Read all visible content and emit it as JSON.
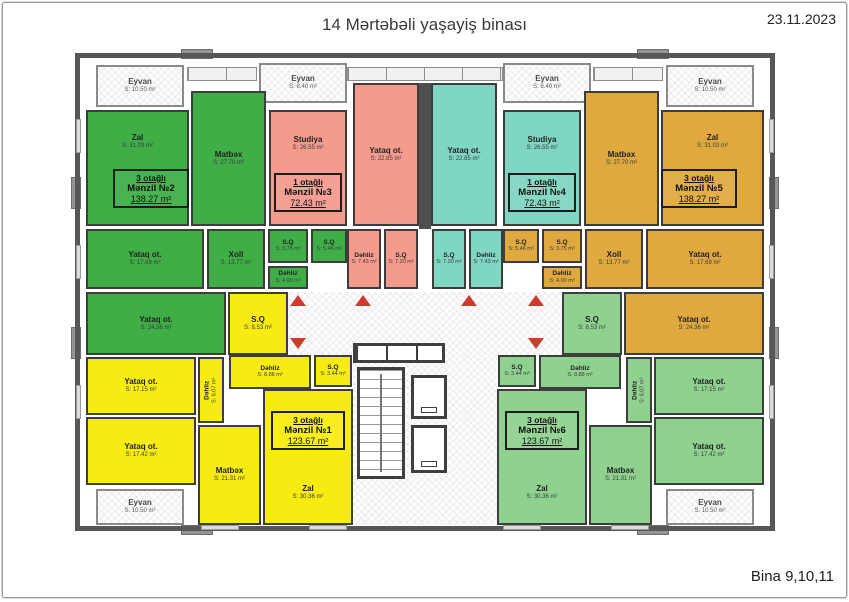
{
  "header": {
    "title": "14 Mərtəbəli yaşayiş binası",
    "date": "23.11.2023"
  },
  "footer": {
    "building": "Bina 9,10,11"
  },
  "colors": {
    "apt1": "#f7ec11",
    "apt2": "#3fae47",
    "apt3": "#f59b8e",
    "apt4": "#7fd6c2",
    "apt5": "#e0a93f",
    "apt6": "#8fd28f",
    "arrow": "#cd3a2e",
    "wall": "#4f4f4f"
  },
  "plan": {
    "rooms": [
      {
        "id": "eyvan-2",
        "apt": 2,
        "balcony": true,
        "name": "Eyvan",
        "area": "S: 10.50 m²",
        "x": 15,
        "y": 6,
        "w": 88,
        "h": 42
      },
      {
        "id": "eyvan-3",
        "apt": 3,
        "balcony": true,
        "name": "Eyvan",
        "area": "S: 8.40 m²",
        "x": 178,
        "y": 4,
        "w": 88,
        "h": 40
      },
      {
        "id": "eyvan-4",
        "apt": 4,
        "balcony": true,
        "name": "Eyvan",
        "area": "S: 8.40 m²",
        "x": 422,
        "y": 4,
        "w": 88,
        "h": 40
      },
      {
        "id": "eyvan-5",
        "apt": 5,
        "balcony": true,
        "name": "Eyvan",
        "area": "S: 10.50 m²",
        "x": 585,
        "y": 6,
        "w": 88,
        "h": 42
      },
      {
        "id": "zal-2",
        "apt": 2,
        "name": "Zal",
        "area": "S: 31.03 m²",
        "x": 5,
        "y": 51,
        "w": 103,
        "h": 116,
        "ty": -26
      },
      {
        "id": "matbex-2",
        "apt": 2,
        "name": "Matbəx",
        "area": "S: 27.70 m²",
        "x": 110,
        "y": 32,
        "w": 75,
        "h": 135
      },
      {
        "id": "yataq-2a",
        "apt": 2,
        "name": "Yataq ot.",
        "area": "S: 17.69 m²",
        "x": 5,
        "y": 170,
        "w": 118,
        "h": 60
      },
      {
        "id": "xoll-2",
        "apt": 2,
        "name": "Xoll",
        "area": "S: 13.77 m²",
        "x": 126,
        "y": 170,
        "w": 58,
        "h": 60
      },
      {
        "id": "sq-2a",
        "apt": 2,
        "small": true,
        "name": "S.Q",
        "area": "S: 3.75 m²",
        "x": 187,
        "y": 170,
        "w": 40,
        "h": 34
      },
      {
        "id": "sq-2b",
        "apt": 2,
        "small": true,
        "name": "S.Q",
        "area": "S: 5.46 m²",
        "x": 230,
        "y": 170,
        "w": 36,
        "h": 34
      },
      {
        "id": "dehliz-2",
        "apt": 2,
        "small": true,
        "name": "Dəhliz",
        "area": "S: 4.00 m²",
        "x": 187,
        "y": 207,
        "w": 40,
        "h": 23
      },
      {
        "id": "yataq-2b",
        "apt": 2,
        "name": "Yataq ot.",
        "area": "S: 24.36 m²",
        "x": 5,
        "y": 233,
        "w": 140,
        "h": 63
      },
      {
        "id": "studiya-3",
        "apt": 3,
        "name": "Studiya",
        "area": "S: 26.55 m²",
        "x": 188,
        "y": 51,
        "w": 78,
        "h": 116,
        "ty": -24
      },
      {
        "id": "yataq-3",
        "apt": 3,
        "name": "Yataq ot.",
        "area": "S: 22.85 m²",
        "x": 272,
        "y": 24,
        "w": 66,
        "h": 143
      },
      {
        "id": "dehliz-3",
        "apt": 3,
        "small": true,
        "name": "Dəhliz",
        "area": "S: 7.43 m²",
        "x": 266,
        "y": 170,
        "w": 34,
        "h": 60
      },
      {
        "id": "sq-3",
        "apt": 3,
        "small": true,
        "name": "S.Q",
        "area": "S: 7.20 m²",
        "x": 303,
        "y": 170,
        "w": 34,
        "h": 60
      },
      {
        "id": "yataq-4",
        "apt": 4,
        "name": "Yataq ot.",
        "area": "S: 22.85 m²",
        "x": 350,
        "y": 24,
        "w": 66,
        "h": 143
      },
      {
        "id": "studiya-4",
        "apt": 4,
        "name": "Studiya",
        "area": "S: 26.55 m²",
        "x": 422,
        "y": 51,
        "w": 78,
        "h": 116,
        "ty": -24
      },
      {
        "id": "sq-4",
        "apt": 4,
        "small": true,
        "name": "S.Q",
        "area": "S: 7.20 m²",
        "x": 351,
        "y": 170,
        "w": 34,
        "h": 60
      },
      {
        "id": "dehliz-4",
        "apt": 4,
        "small": true,
        "name": "Dəhliz",
        "area": "S: 7.43 m²",
        "x": 388,
        "y": 170,
        "w": 34,
        "h": 60
      },
      {
        "id": "matbex-5",
        "apt": 5,
        "name": "Matbəx",
        "area": "S: 27.70 m²",
        "x": 503,
        "y": 32,
        "w": 75,
        "h": 135
      },
      {
        "id": "zal-5",
        "apt": 5,
        "name": "Zal",
        "area": "S: 31.03 m²",
        "x": 580,
        "y": 51,
        "w": 103,
        "h": 116,
        "ty": -26
      },
      {
        "id": "sq-5b",
        "apt": 5,
        "small": true,
        "name": "S.Q",
        "area": "S: 5.46 m²",
        "x": 422,
        "y": 170,
        "w": 36,
        "h": 34
      },
      {
        "id": "sq-5a",
        "apt": 5,
        "small": true,
        "name": "S.Q",
        "area": "S: 3.75 m²",
        "x": 461,
        "y": 170,
        "w": 40,
        "h": 34
      },
      {
        "id": "dehliz-5",
        "apt": 5,
        "small": true,
        "name": "Dəhliz",
        "area": "S: 4.00 m²",
        "x": 461,
        "y": 207,
        "w": 40,
        "h": 23
      },
      {
        "id": "xoll-5",
        "apt": 5,
        "name": "Xoll",
        "area": "S: 13.77 m²",
        "x": 504,
        "y": 170,
        "w": 58,
        "h": 60
      },
      {
        "id": "yataq-5a",
        "apt": 5,
        "name": "Yataq ot.",
        "area": "S: 17.69 m²",
        "x": 565,
        "y": 170,
        "w": 118,
        "h": 60
      },
      {
        "id": "yataq-5b",
        "apt": 5,
        "name": "Yataq ot.",
        "area": "S: 24.36 m²",
        "x": 543,
        "y": 233,
        "w": 140,
        "h": 63
      },
      {
        "id": "sq-1a",
        "apt": 1,
        "name": "S.Q",
        "area": "S: 8.53 m²",
        "x": 147,
        "y": 233,
        "w": 60,
        "h": 63
      },
      {
        "id": "yataq-1a",
        "apt": 1,
        "name": "Yataq ot.",
        "area": "S: 17.15 m²",
        "x": 5,
        "y": 298,
        "w": 110,
        "h": 58
      },
      {
        "id": "dehliz-1b",
        "apt": 1,
        "small": true,
        "vertical": true,
        "name": "Dəhliz",
        "area": "S: 6.07 m²",
        "x": 117,
        "y": 298,
        "w": 26,
        "h": 66
      },
      {
        "id": "dehliz-1a",
        "apt": 1,
        "small": true,
        "name": "Dəhliz",
        "area": "S: 8.88 m²",
        "x": 148,
        "y": 296,
        "w": 82,
        "h": 34
      },
      {
        "id": "sq-1b",
        "apt": 1,
        "small": true,
        "name": "S.Q",
        "area": "S: 3.44 m²",
        "x": 233,
        "y": 296,
        "w": 38,
        "h": 32
      },
      {
        "id": "yataq-1b",
        "apt": 1,
        "name": "Yataq ot.",
        "area": "S: 17.42 m²",
        "x": 5,
        "y": 358,
        "w": 110,
        "h": 68
      },
      {
        "id": "matbex-1",
        "apt": 1,
        "name": "Matbəx",
        "area": "S: 21.31 m²",
        "x": 117,
        "y": 366,
        "w": 63,
        "h": 100
      },
      {
        "id": "zal-1",
        "apt": 1,
        "name": "Zal",
        "area": "S: 30.36 m²",
        "x": 182,
        "y": 330,
        "w": 90,
        "h": 136,
        "ty": 36
      },
      {
        "id": "eyvan-1",
        "apt": 1,
        "balcony": true,
        "name": "Eyvan",
        "area": "S: 10.50 m²",
        "x": 15,
        "y": 430,
        "w": 88,
        "h": 36
      },
      {
        "id": "sq-6a",
        "apt": 6,
        "name": "S.Q",
        "area": "S: 8.53 m²",
        "x": 481,
        "y": 233,
        "w": 60,
        "h": 63
      },
      {
        "id": "sq-6b",
        "apt": 6,
        "small": true,
        "name": "S.Q",
        "area": "S: 3.44 m²",
        "x": 417,
        "y": 296,
        "w": 38,
        "h": 32
      },
      {
        "id": "dehliz-6a",
        "apt": 6,
        "small": true,
        "name": "Dəhliz",
        "area": "S: 8.88 m²",
        "x": 458,
        "y": 296,
        "w": 82,
        "h": 34
      },
      {
        "id": "dehliz-6b",
        "apt": 6,
        "small": true,
        "vertical": true,
        "name": "Dəhliz",
        "area": "S: 6.07 m²",
        "x": 545,
        "y": 298,
        "w": 26,
        "h": 66
      },
      {
        "id": "yataq-6a",
        "apt": 6,
        "name": "Yataq ot.",
        "area": "S: 17.15 m²",
        "x": 573,
        "y": 298,
        "w": 110,
        "h": 58
      },
      {
        "id": "yataq-6b",
        "apt": 6,
        "name": "Yataq ot.",
        "area": "S: 17.42 m²",
        "x": 573,
        "y": 358,
        "w": 110,
        "h": 68
      },
      {
        "id": "zal-6",
        "apt": 6,
        "name": "Zal",
        "area": "S: 30.36 m²",
        "x": 416,
        "y": 330,
        "w": 90,
        "h": 136,
        "ty": 36
      },
      {
        "id": "matbex-6",
        "apt": 6,
        "name": "Matbəx",
        "area": "S: 21.31 m²",
        "x": 508,
        "y": 366,
        "w": 63,
        "h": 100
      },
      {
        "id": "eyvan-6",
        "apt": 6,
        "balcony": true,
        "name": "Eyvan",
        "area": "S: 10.50 m²",
        "x": 585,
        "y": 430,
        "w": 88,
        "h": 36
      }
    ],
    "unit_labels": [
      {
        "apt": 2,
        "lines": [
          "3 otağlı",
          "Mənzil №2",
          "138.27 m²"
        ],
        "x": 32,
        "y": 110,
        "w": 76
      },
      {
        "apt": 3,
        "lines": [
          "1 otağlı",
          "Mənzil №3",
          "72.43 m²"
        ],
        "x": 193,
        "y": 114,
        "w": 68
      },
      {
        "apt": 4,
        "lines": [
          "1 otağlı",
          "Mənzil №4",
          "72.43 m²"
        ],
        "x": 427,
        "y": 114,
        "w": 68
      },
      {
        "apt": 5,
        "lines": [
          "3 otağlı",
          "Mənzil №5",
          "138.27 m²"
        ],
        "x": 580,
        "y": 110,
        "w": 76
      },
      {
        "apt": 1,
        "lines": [
          "3 otağlı",
          "Mənzil №1",
          "123.67 m²"
        ],
        "x": 190,
        "y": 352,
        "w": 74
      },
      {
        "apt": 6,
        "lines": [
          "3 otağlı",
          "Mənzil №6",
          "123.67 m²"
        ],
        "x": 424,
        "y": 352,
        "w": 74
      }
    ],
    "corridors": [
      {
        "x": 207,
        "y": 233,
        "w": 274,
        "h": 63
      },
      {
        "x": 272,
        "y": 296,
        "w": 144,
        "h": 170
      }
    ],
    "core": {
      "vestibule": {
        "x": 272,
        "y": 284,
        "w": 92,
        "h": 20
      },
      "stairs": {
        "x": 276,
        "y": 308,
        "w": 48,
        "h": 112
      },
      "elevators": [
        {
          "x": 330,
          "y": 316,
          "w": 36,
          "h": 44
        },
        {
          "x": 330,
          "y": 366,
          "w": 36,
          "h": 48
        }
      ]
    },
    "walls": [
      {
        "x": 338,
        "y": 24,
        "w": 12,
        "h": 146
      }
    ],
    "window_bands": [
      {
        "x": 266,
        "y": 8,
        "w": 156,
        "h": 14
      },
      {
        "x": 106,
        "y": 8,
        "w": 70,
        "h": 14
      },
      {
        "x": 512,
        "y": 8,
        "w": 70,
        "h": 14
      }
    ],
    "entrance_arrows": [
      {
        "x": 217,
        "y": 236,
        "dir": "up"
      },
      {
        "x": 282,
        "y": 236,
        "dir": "up"
      },
      {
        "x": 388,
        "y": 236,
        "dir": "up"
      },
      {
        "x": 455,
        "y": 236,
        "dir": "up"
      },
      {
        "x": 217,
        "y": 279,
        "dir": "down"
      },
      {
        "x": 455,
        "y": 279,
        "dir": "down"
      }
    ]
  }
}
